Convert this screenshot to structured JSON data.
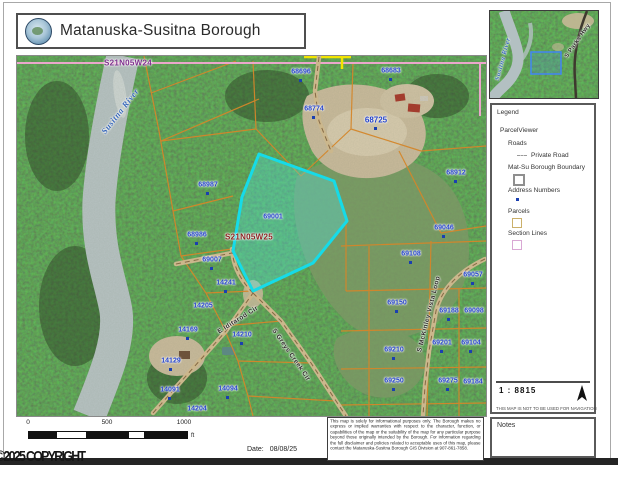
{
  "header": {
    "title": "Matanuska-Susitna Borough"
  },
  "map": {
    "highlighted_parcel": "69001",
    "parcel_labels": [
      {
        "text": "68696",
        "x": 284,
        "y": 16,
        "dot": true
      },
      {
        "text": "68683",
        "x": 374,
        "y": 15,
        "dot": true
      },
      {
        "text": "68774",
        "x": 297,
        "y": 53,
        "dot": true
      },
      {
        "text": "68725",
        "x": 359,
        "y": 64,
        "dot": true,
        "size": 8
      },
      {
        "text": "68912",
        "x": 439,
        "y": 117,
        "dot": true
      },
      {
        "text": "69046",
        "x": 427,
        "y": 172,
        "dot": true
      },
      {
        "text": "68987",
        "x": 191,
        "y": 129,
        "dot": true
      },
      {
        "text": "68986",
        "x": 180,
        "y": 179,
        "dot": true
      },
      {
        "text": "69001",
        "x": 256,
        "y": 161
      },
      {
        "text": "69007",
        "x": 195,
        "y": 204,
        "dot": true
      },
      {
        "text": "14241",
        "x": 209,
        "y": 227,
        "dot": true
      },
      {
        "text": "14205",
        "x": 186,
        "y": 250
      },
      {
        "text": "14169",
        "x": 171,
        "y": 274,
        "dot": true
      },
      {
        "text": "14210",
        "x": 225,
        "y": 279,
        "dot": true
      },
      {
        "text": "14129",
        "x": 154,
        "y": 305,
        "dot": true
      },
      {
        "text": "14091",
        "x": 153,
        "y": 334,
        "dot": true
      },
      {
        "text": "14094",
        "x": 211,
        "y": 333,
        "dot": true
      },
      {
        "text": "14204",
        "x": 180,
        "y": 353
      },
      {
        "text": "69108",
        "x": 394,
        "y": 198,
        "dot": true
      },
      {
        "text": "69057",
        "x": 456,
        "y": 219,
        "dot": true
      },
      {
        "text": "69150",
        "x": 380,
        "y": 247,
        "dot": true
      },
      {
        "text": "69188",
        "x": 432,
        "y": 255,
        "dot": true
      },
      {
        "text": "69098",
        "x": 457,
        "y": 255
      },
      {
        "text": "69201",
        "x": 425,
        "y": 287,
        "dot": true
      },
      {
        "text": "69104",
        "x": 454,
        "y": 287,
        "dot": true
      },
      {
        "text": "69210",
        "x": 377,
        "y": 294,
        "dot": true
      },
      {
        "text": "69250",
        "x": 377,
        "y": 325,
        "dot": true
      },
      {
        "text": "69275",
        "x": 431,
        "y": 325,
        "dot": true
      },
      {
        "text": "69184",
        "x": 456,
        "y": 326
      }
    ],
    "section_labels": [
      {
        "text": "S21N05W24",
        "x": 111,
        "y": 7,
        "color": "#7b2d8b"
      },
      {
        "text": "S21N05W25",
        "x": 232,
        "y": 181,
        "color": "#8b2020"
      }
    ],
    "road_labels": [
      {
        "text": "Susitna River",
        "x": 103,
        "y": 55,
        "angle": -52,
        "river": true,
        "size": 8.5
      },
      {
        "text": "E Iditarod Cir",
        "x": 221,
        "y": 264,
        "angle": -32
      },
      {
        "text": "S Greys Creek Cir",
        "x": 274,
        "y": 299,
        "angle": 55
      },
      {
        "text": "S McKinley Vista Loop",
        "x": 412,
        "y": 258,
        "angle": -76
      }
    ]
  },
  "inset": {
    "labels": [
      {
        "text": "Susitna River",
        "x": 13,
        "y": 48,
        "angle": -75,
        "river": true,
        "size": 6.5
      },
      {
        "text": "S Parks Hwy",
        "x": 88,
        "y": 30,
        "angle": -55,
        "size": 6
      }
    ]
  },
  "legend": {
    "title": "Legend",
    "group": "ParcelViewer",
    "roads_header": "Roads",
    "items": [
      {
        "label": "Private Road",
        "symbol": "dashed-line"
      },
      {
        "label": "Mat-Su Borough Boundary",
        "symbol": "gray-square"
      },
      {
        "label": "Address Numbers",
        "symbol": "blue-dot"
      },
      {
        "label": "Parcels",
        "symbol": "tan-square"
      },
      {
        "label": "Section Lines",
        "symbol": "pink-square"
      }
    ]
  },
  "scale_panel": {
    "ratio": "1 : 8815",
    "warning": "THIS MAP IS NOT TO BE USED FOR NAVIGATION"
  },
  "notes_panel": {
    "label": "Notes"
  },
  "scalebar": {
    "ticks": [
      "0",
      "500",
      "1000"
    ],
    "unit": "ft"
  },
  "footer": {
    "date_label": "Date:",
    "date_value": "08/08/25",
    "copyright": "©2025 COPYRIGHT"
  },
  "disclaimer_text": "This map is solely for informational purposes only. The Borough makes no express or implied warranties with respect to the character, function, or capabilities of the map or the suitability of the map for any particular purpose beyond those originally intended by the Borough. For information regarding the full disclaimer and policies related to acceptable uses of this map, please contact the Matanuska-Susitna Borough GIS Division at 907-861-7858.",
  "colors": {
    "highlight_stroke": "#16dbe8",
    "parcel_line": "#d4862a",
    "section_line": "#eba7cc",
    "parcel_label": "#2140c8",
    "river": "#b7c2c2"
  }
}
